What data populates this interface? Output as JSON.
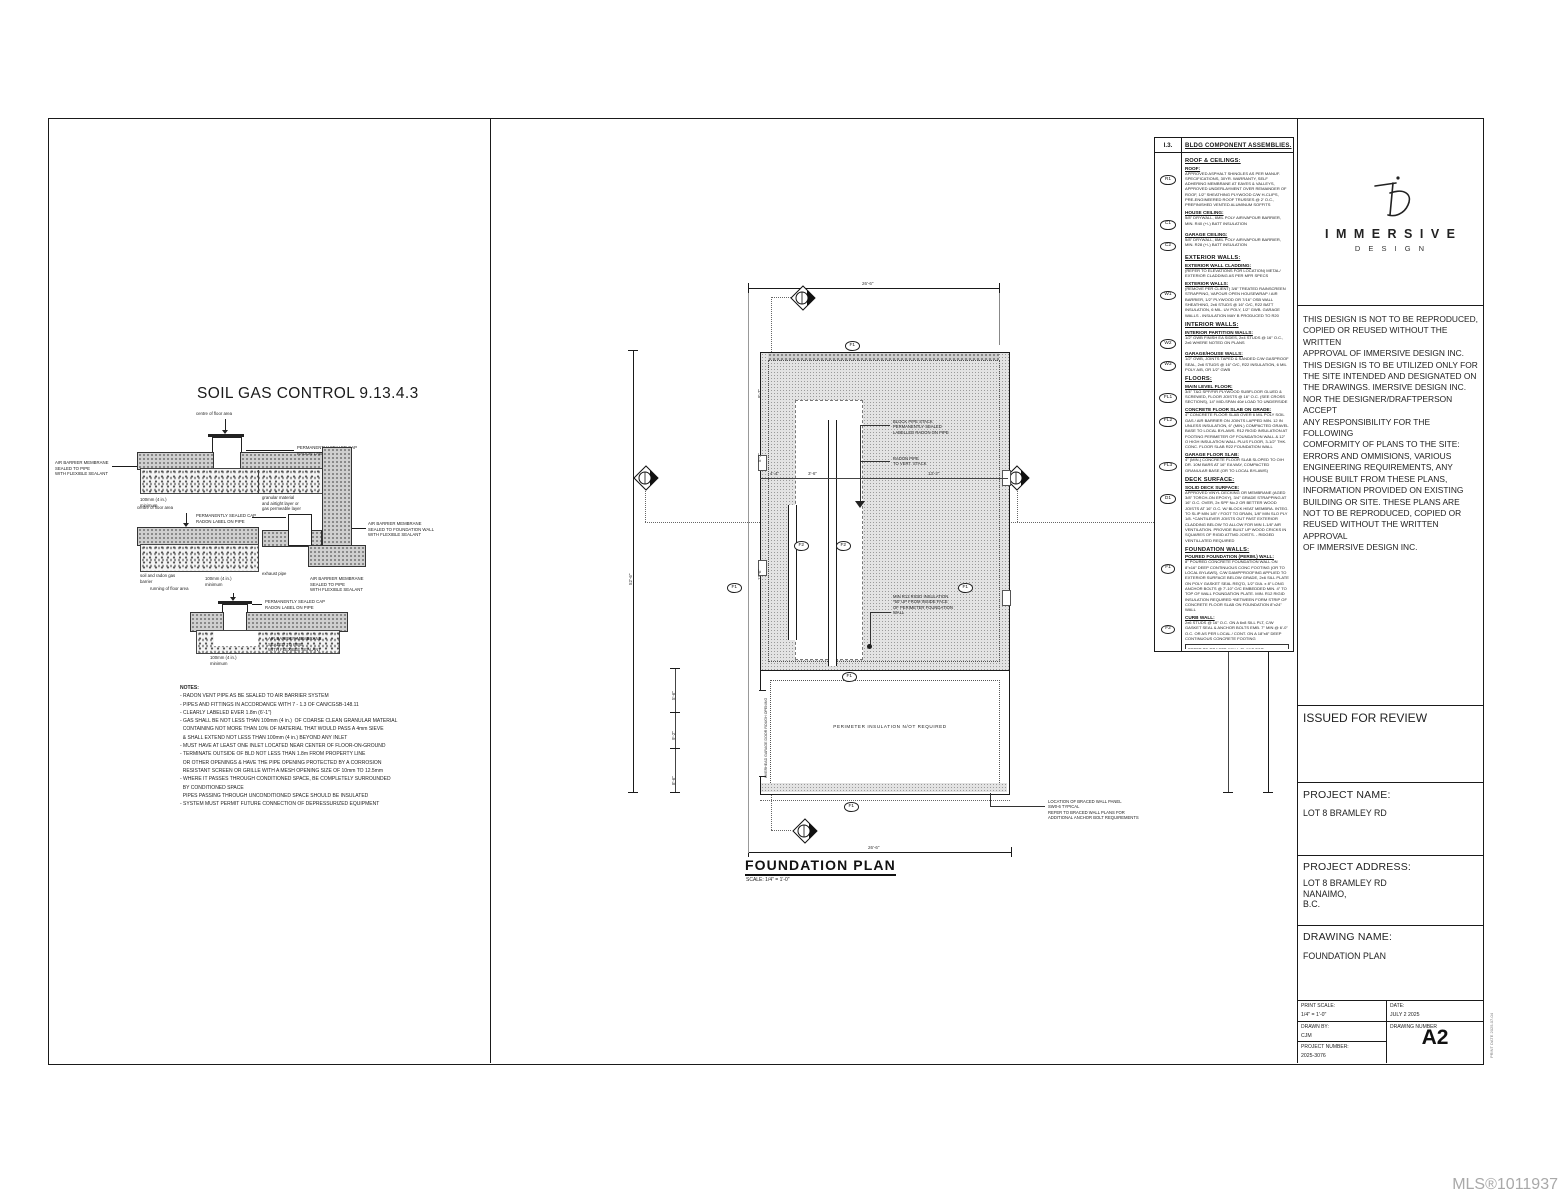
{
  "watermark": "MLS®1011937",
  "left_panel": {
    "title": "SOIL GAS CONTROL 9.13.4.3",
    "d1": {
      "arrow_top": "centre of floor area",
      "cap": "PERMANENTLY SEALED CAP\nRADON LABEL ON PIPE",
      "left": "AIR BARRIER MEMBRANE\nSEALED TO PIPE\nWITH FLEXIBLE SEALANT",
      "bottom_left": "100mm (4 in.)\nminimum",
      "bottom_right": "granular material\nand airtight layer or\ngas permeable layer"
    },
    "d2": {
      "arrow_top": "centre of floor area",
      "cap": "PERMANENTLY SEALED CAP\nRADON LABEL ON PIPE",
      "right": "AIR BARRIER MEMBRANE\nSEALED TO FOUNDATION WALL\nWITH FLEXIBLE SEALANT",
      "bottom1": "soil and radon gas\nbarrier",
      "bottom2": "100mm (4 in.)\nminimum",
      "bottom3": "exhaust pipe",
      "bottom4": "AIR BARRIER MEMBRANE\nSEALED TO PIPE\nWITH FLEXIBLE SEALANT"
    },
    "d3": {
      "arrow_top": "running of floor area",
      "cap": "PERMANENTLY SEALED CAP\nRADON LABEL ON PIPE",
      "right": "AIR BARRIER MEMBRANE\nSEALED TO PIPE\nWITH FLEXIBLE SEALANT",
      "bottom": "100mm (4 in.)\nminimum"
    },
    "notes_title": "NOTES:",
    "notes": [
      "- RADON VENT PIPE AS BE SEALED TO AIR BARRIER SYSTEM",
      "- PIPES AND FITTINGS IN ACCORDANCE WITH 7 - 1.3 OF CAN/CGSB-148.11",
      "- CLEARLY LABELED EVER 1.8m (6'-1\")",
      "- GAS SHALL BE NOT LESS THAN 100mm (4 in.)  OF COARSE CLEAN GRANULAR MATERIAL",
      "  CONTAINING NOT MORE THAN 10% OF MATERIAL THAT WOULD PASS A 4mm SIEVE",
      "  & SHALL EXTEND NOT LESS THAN 100mm (4 in.) BEYOND ANY INLET",
      "- MUST HAVE AT LEAST ONE INLET LOCATED NEAR CENTER OF FLOOR-ON-GROUND",
      "- TERMINATE OUTSIDE OF BLD NOT LESS THAN 1.8m FROM PROPERTY LINE",
      "  OR OTHER OPENINGS & HAVE THE PIPE OPENING PROTECTED BY A CORROSION",
      "  RESISTANT SCREEN OR GRILLE WITH A MESH OPENING SIZE OF 10mm TO 12.5mm",
      "- WHERE IT PASSES THROUGH CONDITIONED SPACE, BE COMPLETELY SURROUNDED",
      "  BY CONDITIONED SPACE",
      "  PIPES PASSING THROUGH UNCONDITIONED SPACE SHOULD BE INSULATED",
      "- SYSTEM MUST PERMIT FUTURE CONNECTION OF DEPRESSURIZED EQUIPMENT"
    ]
  },
  "plan": {
    "title": "FOUNDATION PLAN",
    "scale": "SCALE: 1/4\" = 1'-0\"",
    "f1": "F1",
    "f2": "F2",
    "annotations": {
      "block_pipe": "BLOCK PIPE STACK\nPERMANENTLY SEALED\nLABELLED RADON ON PIPE",
      "radon_pipe": "RADON PIPE\nTO VERT. STACK",
      "rigid_insulation": "MIN R12 RIGID INSULATION\n*50' UP FROM INSIDE FACE\nOF PERIMETER FOUNDATION\nWALL",
      "perimeter": "PERIMETER  INSULATION N/OT REQUIRED",
      "braced_wall": "LOCATION OF BRACED WALL PANEL\nSW0-6   TYPICAL\nREFER TO BRACED WALL PLANS FOR\nADDITIONAL ANCHOR BOLT REQUIREMENTS",
      "garage_door": "OVERHEAD GARAGE DOOR ROUGH OPENING"
    },
    "dims": {
      "top": "26'-6\"",
      "bottom": "26'-6\"",
      "left_overall": "52'-6\"",
      "right_outer": "52'-6\"",
      "right_inner": "30'-0\"",
      "left_seg1": "5'-6\"",
      "left_seg2": "9'-2\"",
      "left_seg3": "8'-6\"",
      "inner_h1": "4'-4\"",
      "inner_h2": "3'-6\"",
      "inner_h3": "13'-2\"",
      "inner_v1": "8'-7\"",
      "inner_v2": "5'-7\"",
      "inner_v3": "11'-6\""
    }
  },
  "assemblies": {
    "header_tag": "I.3.",
    "header_title": "BLDG COMPONENT ASSEMBLIES.",
    "rows": [
      {
        "kind": "sec",
        "tag": "",
        "heading": "ROOF & CEILINGS:",
        "body": ""
      },
      {
        "kind": "item",
        "tag": "R1",
        "heading": "ROOF:",
        "body": "APPROVED ASPHALT SHINGLES AS PER MANUF. SPECIFICATIONS, 30YR. WARRANTY, SELF ADHERING MEMBRANE AT EAVES & VALLEYS, APPROVED UNDERLAYMENT OVER REMAINDER OF ROOF, 1/2\" SHEATHING PLYWOOD C/W H-CLIPS, PRE-ENGINEERED ROOF TRUSSES @ 2' O.C., PREFINISHED VENTED ALUMINUM SOFFITS"
      },
      {
        "kind": "item",
        "tag": "C1",
        "heading": "HOUSE CEILING:",
        "body": "5/8\" DRYWALL, 6MIL POLY  AIR/VAPOUR BARRIER, MIN. R40 (+/-) BATT INSULATION"
      },
      {
        "kind": "item",
        "tag": "C2",
        "heading": "GARAGE CEILING:",
        "body": "5/8\" DRYWALL, 6MIL POLY  AIR/VAPOUR BARRIER, MIN. R28 (+/-) BATT INSULATION"
      },
      {
        "kind": "sec",
        "tag": "",
        "heading": "EXTERIOR WALLS:",
        "body": ""
      },
      {
        "kind": "item",
        "tag": "",
        "heading": "EXTERIOR WALL CLADDING:",
        "body": "(REFER TO ELEVATIONS FOR LOCATION) METAL/ EXTERIOR CLADDING AS PER MFR SPECS"
      },
      {
        "kind": "item",
        "tag": "W1",
        "heading": "EXTERIOR WALLS:",
        "body": "(REMOVE PER CLIENT) 3/8\" TREATED RAINSCREEN STRAPPING, VAPOUR OPEN HOUSEWRAP / AIR BARRIER, 1/2\" PLYWOOD OR 7/16\" OSB WALL SHEATHING, 2x6 STUDS @ 16\" O/C, R22 BATT INSULATION, 6 MIL. UV POLY, 1/2\" GWB. GARAGE WALLS - INSULATION MAY B PRODUCED TO R20"
      },
      {
        "kind": "sec",
        "tag": "",
        "heading": "INTERIOR WALLS:",
        "body": ""
      },
      {
        "kind": "item",
        "tag": "W2",
        "heading": "INTERIOR PARTITION WALLS:",
        "body": "1/2\" GWB FINISH EA SIDES, 2x4 STUDS @ 16\" O.C., 2x6 WHERE NOTED ON PLANS"
      },
      {
        "kind": "item",
        "tag": "W3",
        "heading": "GARAGE/HOUSE WALLS:",
        "body": "1/2\" GWB, JOINTS TAPED & SANDED C/W GASPROOF SEAL, 2x6 STUDS @ 16\" O/C, R22 INSULATION, 6 MIL POLY A/B, OR 1/2\" GWB"
      },
      {
        "kind": "sec",
        "tag": "",
        "heading": "FLOORS:",
        "body": ""
      },
      {
        "kind": "item",
        "tag": "FL1",
        "heading": "MAIN LEVEL FLOOR:",
        "body": "3/4\" T&G SPF/FIR PLYWOOD SUBFLOOR GLUED & SCREWED, FLOOR JOISTS @ 16\" O.C. (SEE CROSS SECTIONS), 14\" MID-SPAN 40# LOAD TO UNDERSIDE"
      },
      {
        "kind": "item",
        "tag": "FL2",
        "heading": "CONCRETE FLOOR SLAB ON GRADE:",
        "body": "4\" CONCRETE FLOOR SLAB OVER 6 MIL POLY SOIL GAS / AIR BARRIER ON JOINTS LAPPED MIN. 12 IN UNLESS INSULATION, 6\" (MIN.) COMPACTED GRAVEL BASE TO LOCAL BYLAWS. R12 RIGID INSULATION AT FOOTING PERIMETER OF FOUNDATION WALL & 12\" O HIGH INSULATION WALL PLUS FLOOR, 3-1/2\" THK. CONC. FLOOR SLAB R22 FOUNDATION WALL"
      },
      {
        "kind": "item",
        "tag": "FL3",
        "heading": "GARAGE FLOOR SLAB:",
        "body": "4\" (MIN.) CONCRETE FLOOR SLAB SLOPED TO O/H DR. 10M BARS AT 16\" EA WAY, COMPACTED GRANULAR BASE (OR TO LOCAL BYLAWS)"
      },
      {
        "kind": "sec",
        "tag": "",
        "heading": "DECK SURFACE:",
        "body": ""
      },
      {
        "kind": "item",
        "tag": "D1",
        "heading": "SOLID DECK SURFACE:",
        "body": "APPROVED VINYL DECKING OR MEMBRANE (AGED 3/8\" TORCH-ON EPOXY), 3/4\" GRADE STRAPPING AT 16\" O.C. OVER, 2x SPF No.2 OR BETTER WOOD JOISTS AT 16\" O.C. W/ BLOCK HEAT MEMBRA. INTEG. TO SLIP MIN 1/8\" / FOOT TO DRAIN, 1/8\" MIN SLO PLY 1/8. *CANTILEVER JOISTS OUT PAST EXTERIOR CLADDING BELOW TO ALLOW FOR MIN 1-1/8\" AIR VENTILATION. PROVIDE BUILT UP WOOD CRICKS IN SQUARES OF RIGID ATTMD JOISTS. - RIDGED VENTILLATED REQUIRED"
      },
      {
        "kind": "sec",
        "tag": "",
        "heading": "FOUNDATION WALLS:",
        "body": ""
      },
      {
        "kind": "item",
        "tag": "F1",
        "heading": "POURED FOUNDATION (PERIM.) WALL:",
        "body": "8\" POURED CONCRETE FOUNDATION WALL ON 8\"x16\" DEEP CONTINUOUS CONC FOOTING (OR TO LOCAL BYLAWS), C/W DAMPPROOFING APPLIED TO EXTERIOR SURFACE BELOW GRADE, 2x6 SILL PLATE ON POLY GASKET SEAL REQ'D, 1/2\" DIA. x 8\" LONG ANCHOR BOLTS @ 7'-10\" O/C EMBEDDED MIN. 4\" TO TOP OF WALL FOUNDATION PLATE. MIN. R12 RIGID INSULATION REQUIRED *BETWEEN FORM STRIP OF CONCRETE FLOOR SLAB ON FOUNDATION 8\"x24\" WALL"
      },
      {
        "kind": "item",
        "tag": "F2",
        "heading": "CURB WALL:",
        "body": "2x6 STUDS @ 16\" O.C. ON A 6x8 SILL PLT, C/W GASKET SEAL & ANCHOR BOLTS EMB. 7\" MIN @ 6'-0\" O.C. OR AS PER LOCAL / CONT. ON A 18\"x8\" DEEP CONTINUOUS CONCRETE FOOTING"
      },
      {
        "kind": "note",
        "tag": "",
        "heading": "",
        "body": "REFER TO BRACED WALL PLANS FOR ADDITIONAL ANCHOR BOLT REQUIREMENTS"
      }
    ]
  },
  "title_block": {
    "brand_name": "I M M E R S I V E",
    "brand_sub": "D  E  S  I  G  N",
    "disclaimer": "THIS DESIGN IS NOT TO BE REPRODUCED,\nCOPIED OR REUSED WITHOUT THE WRITTEN\nAPPROVAL OF IMMERSIVE DESIGN INC.\nTHIS DESIGN IS TO BE UTILIZED ONLY FOR\nTHE SITE INTENDED AND DESIGNATED ON\nTHE DRAWINGS. IMERSIVE DESIGN INC.\nNOR THE  DESIGNER/DRAFTPERSON ACCEPT\nANY RESPONSIBILITY FOR THE FOLLOWING\nCOMFORMITY OF PLANS TO THE SITE:\nERRORS AND OMMISIONS, VARIOUS\nENGINEERING REQUIREMENTS, ANY\nHOUSE BUILT FROM THESE PLANS,\nINFORMATION PROVIDED ON EXISTING\nBUILDING OR SITE. THESE PLANS ARE\nNOT TO BE REPRODUCED, COPIED OR\nREUSED WITHOUT THE WRITTEN APPROVAL\nOF  IMMERSIVE DESIGN INC.",
    "status": "ISSUED FOR REVIEW",
    "project_name_label": "PROJECT NAME:",
    "project_name": "LOT 8 BRAMLEY RD",
    "project_address_label": "PROJECT ADDRESS:",
    "project_address": "LOT 8 BRAMLEY RD\nNANAIMO,\nB.C.",
    "drawing_name_label": "DRAWING NAME:",
    "drawing_name": "FOUNDATION PLAN",
    "print_scale_label": "PRINT SCALE:",
    "print_scale": "1/4\" = 1'-0\"",
    "date_label": "DATE:",
    "date": "JULY 2  2025",
    "drawn_by_label": "DRAWN BY:",
    "drawn_by": "CJM",
    "project_number_label": "PROJECT NUMBER:",
    "project_number": "2025-3076",
    "drawing_number_label": "DRAWING NUMBER",
    "drawing_number": "A2",
    "side_note": "PRINT DATE  2025-07-04"
  }
}
